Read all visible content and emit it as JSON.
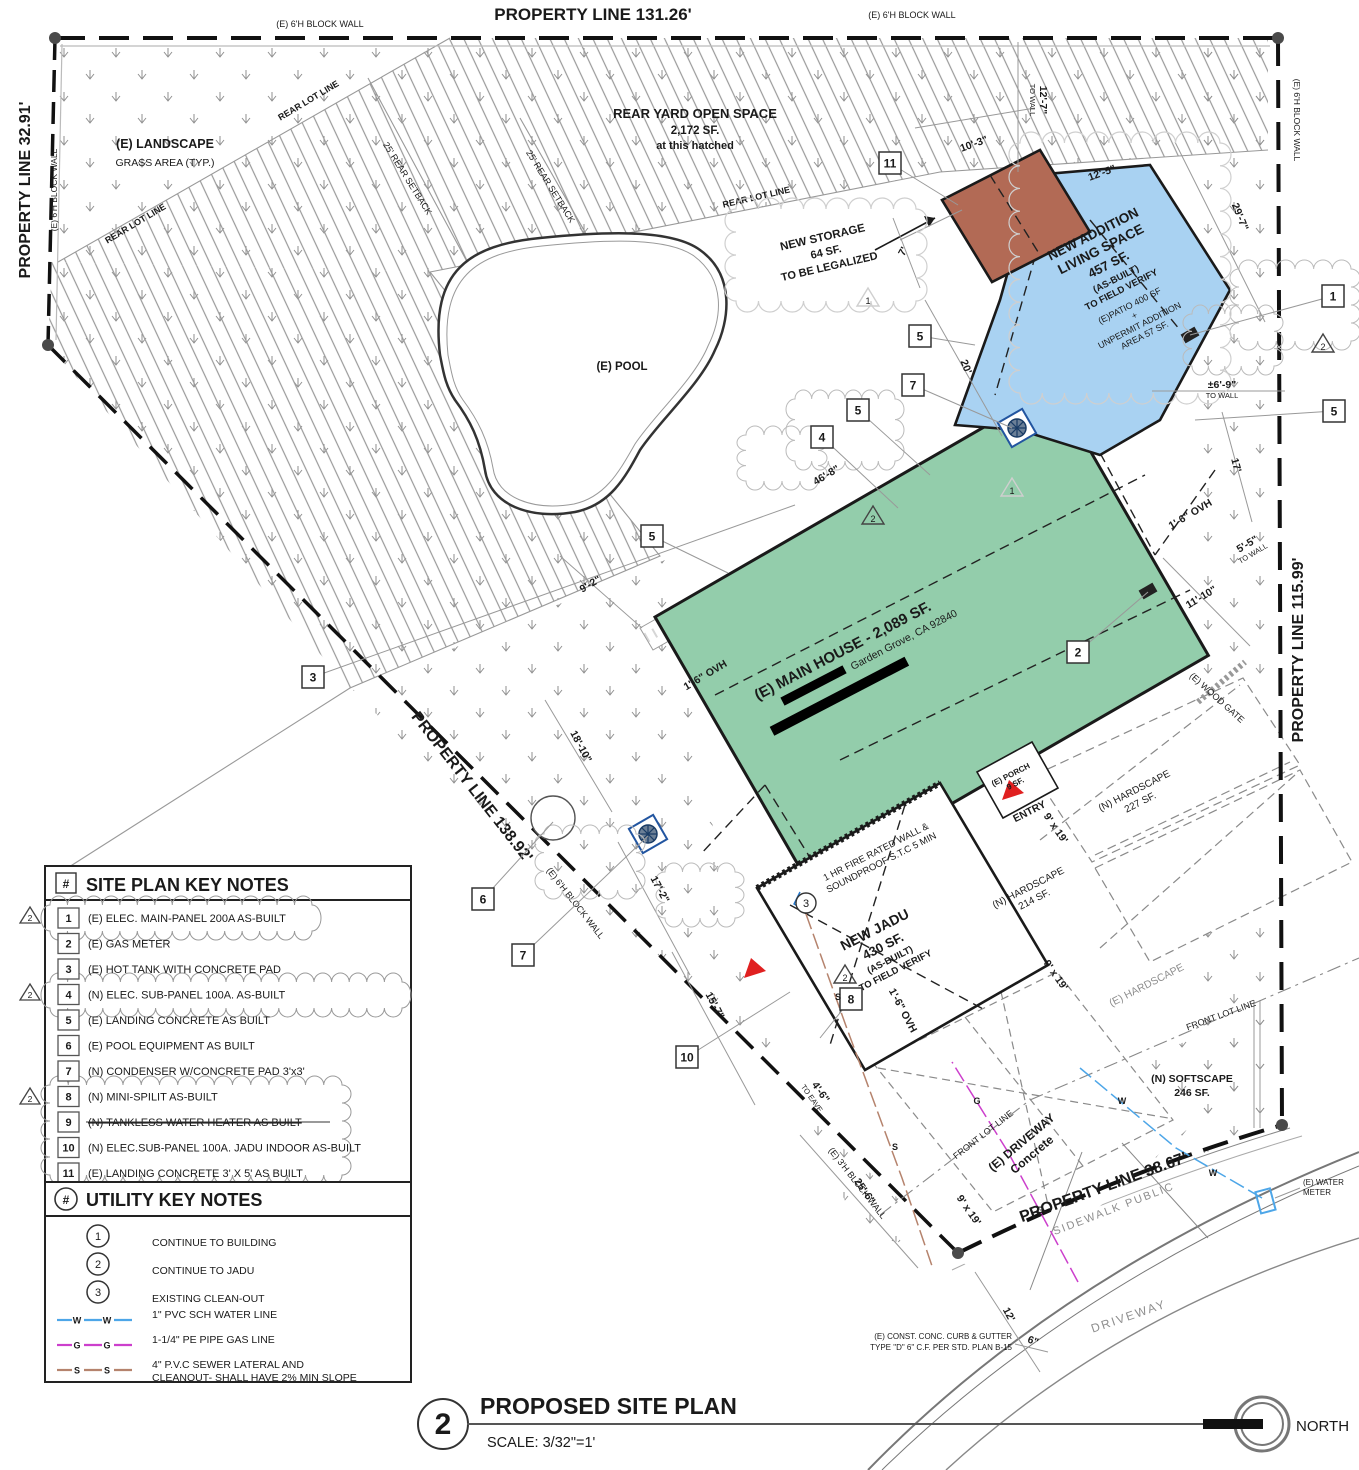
{
  "colors": {
    "house_green": "#93cdab",
    "addition_blue": "#a9d2f2",
    "storage_brown": "#b26a55",
    "hatch_gray": "#9a9a9a",
    "water_blue": "#4da6e8",
    "gas_magenta": "#cc3fcc",
    "sewer_brown": "#b5836d",
    "entry_red": "#e02020"
  },
  "boundary": {
    "top": "PROPERTY LINE 131.26'",
    "left": "PROPERTY LINE 32.91'",
    "right": "PROPERTY LINE 115.99'",
    "rear_diag": "PROPERTY LINE 138.92'",
    "front": "PROPERTY LINE 38.67'",
    "block_wall_6": "(E) 6'H BLOCK WALL",
    "block_wall_3": "(E) 3'H BLOCK WALL",
    "rear_lot_line": "REAR LOT LINE",
    "front_lot_line": "FRONT LOT LINE",
    "rear_setback": "25' REAR SETBACK",
    "sidewalk": "SIDEWALK   PUBLIC",
    "street": "DRIVEWAY",
    "wood_gate": "(E) WOOD GATE",
    "curb_note_1": "(E) CONST. CONC. CURB & GUTTER",
    "curb_note_2": "TYPE \"D\" 6\" C.F. PER STD. PLAN B-15"
  },
  "areas": {
    "landscape_1": "(E) LANDSCAPE",
    "landscape_2": "GRASS AREA (TYP.)",
    "rear_yard_1": "REAR YARD OPEN SPACE",
    "rear_yard_2": "2,172 SF.",
    "rear_yard_3": "at this hatched",
    "pool": "(E) POOL",
    "storage_1": "NEW STORAGE",
    "storage_2": "64 SF.",
    "storage_3": "TO BE LEGALIZED",
    "addition_1": "NEW ADDITION",
    "addition_2": "LIVING SPACE",
    "addition_3": "457 SF.",
    "addition_4": "(AS-BUILT)",
    "addition_5": "TO FIELD VERIFY",
    "addition_6": "(E)PATIO 400 SF",
    "addition_7": "+",
    "addition_8": "UNPERMIT ADDITION",
    "addition_9": "AREA 57 SF.",
    "main_house": "(E) MAIN HOUSE - 2,089 SF.",
    "main_house_addr": "Garden Grove, CA 92840",
    "jadu_1": "NEW JADU",
    "jadu_2": "430 SF.",
    "jadu_3": "(AS-BUILT)",
    "jadu_4": "TO FIELD VERIFY",
    "firewall_1": "1 HR FIRE RATED WALL &",
    "firewall_2": "SOUNDPROOF S.T.C 5 MIN",
    "porch_1": "(E) PORCH",
    "porch_2": "9 SF.",
    "entry": "ENTRY",
    "hardscape227_1": "(N) HARDSCAPE",
    "hardscape227_2": "227 SF.",
    "hardscape214_1": "(N) HARDSCAPE",
    "hardscape214_2": "214 SF.",
    "hardscape_e": "(E) HARDSCAPE",
    "softscape_1": "(N) SOFTSCAPE",
    "softscape_2": "246 SF.",
    "driveway_1": "(E) DRIVEWAY",
    "driveway_2": "Concrete",
    "water_meter_1": "(E) WATER",
    "water_meter_2": "METER"
  },
  "plan": {
    "dims": [
      {
        "t": "10'-3\"",
        "x": 975,
        "y": 147,
        "r": -20
      },
      {
        "t": "12'-5\"",
        "x": 1103,
        "y": 176,
        "r": -20
      },
      {
        "t": "12'-7\"",
        "sub": "TO WALL",
        "x": 1040,
        "y": 100,
        "r": 90
      },
      {
        "t": "29'-7\"",
        "x": 1237,
        "y": 218,
        "r": 68
      },
      {
        "t": "7'",
        "x": 906,
        "y": 253,
        "r": -62
      },
      {
        "t": "20'",
        "x": 963,
        "y": 368,
        "r": 68
      },
      {
        "t": "46'-8\"",
        "x": 828,
        "y": 478,
        "r": -31
      },
      {
        "t": "9'-2\"",
        "x": 592,
        "y": 587,
        "r": -31
      },
      {
        "t": "18'-10\"",
        "x": 578,
        "y": 748,
        "r": 62
      },
      {
        "t": "17'-2\"",
        "x": 657,
        "y": 891,
        "r": 62
      },
      {
        "t": "15'-7\"",
        "x": 712,
        "y": 1007,
        "r": 62
      },
      {
        "t": "4'-6\"",
        "sub": "TO EAVE",
        "x": 818,
        "y": 1094,
        "r": 55
      },
      {
        "t": "25'-6\"",
        "x": 862,
        "y": 1193,
        "r": 55
      },
      {
        "t": "12'",
        "x": 1006,
        "y": 1316,
        "r": 62
      },
      {
        "t": "6\"",
        "x": 1032,
        "y": 1344,
        "r": 20
      },
      {
        "t": "17'",
        "x": 1233,
        "y": 466,
        "r": 75
      },
      {
        "t": "1'-6\" OVH",
        "x": 1192,
        "y": 517,
        "r": -31
      },
      {
        "t": "5'-5\"",
        "sub": "TO WALL",
        "x": 1249,
        "y": 547,
        "r": -31
      },
      {
        "t": "11'-10\"",
        "x": 1203,
        "y": 600,
        "r": -31
      },
      {
        "t": "±6'-9\"",
        "sub": "TO WALL",
        "x": 1222,
        "y": 388,
        "r": 0
      },
      {
        "t": "1'-6\" OVH",
        "x": 707,
        "y": 678,
        "r": -31
      },
      {
        "t": "1'-6\" OVH",
        "x": 900,
        "y": 1012,
        "r": 62
      },
      {
        "t": "9' x 19'",
        "x": 1053,
        "y": 830,
        "r": 55
      },
      {
        "t": "9' x 19'",
        "x": 1053,
        "y": 977,
        "r": 55
      },
      {
        "t": "9' x 19'",
        "x": 966,
        "y": 1212,
        "r": 55
      }
    ],
    "keynote_markers": [
      {
        "n": "11",
        "x": 890,
        "y": 163,
        "tx": 958,
        "ty": 205
      },
      {
        "n": "5",
        "x": 920,
        "y": 336,
        "tx": 975,
        "ty": 345
      },
      {
        "n": "7",
        "x": 913,
        "y": 385,
        "tx": 1012,
        "ty": 428
      },
      {
        "n": "5",
        "x": 858,
        "y": 410,
        "tx": 930,
        "ty": 475
      },
      {
        "n": "4",
        "x": 822,
        "y": 437,
        "tx": 898,
        "ty": 508
      },
      {
        "n": "5",
        "x": 652,
        "y": 536,
        "tx": 728,
        "ty": 573
      },
      {
        "n": "3",
        "x": 313,
        "y": 677,
        "tx": 795,
        "ty": 505
      },
      {
        "n": "2",
        "x": 1078,
        "y": 652,
        "tx": 1148,
        "ty": 592
      },
      {
        "n": "1",
        "x": 1333,
        "y": 296,
        "tx": 1190,
        "ty": 335
      },
      {
        "n": "5",
        "x": 1334,
        "y": 411,
        "tx": 1195,
        "ty": 420
      },
      {
        "n": "6",
        "x": 483,
        "y": 899,
        "tx": 553,
        "ty": 822
      },
      {
        "n": "7",
        "x": 523,
        "y": 955,
        "tx": 648,
        "ty": 836
      },
      {
        "n": "10",
        "x": 687,
        "y": 1057,
        "tx": 790,
        "ty": 992
      },
      {
        "n": "8",
        "x": 851,
        "y": 999,
        "tx": 820,
        "ty": 1038
      }
    ],
    "rev_triangles": [
      {
        "n": "2",
        "x": 1323,
        "y": 344
      },
      {
        "n": "2",
        "x": 873,
        "y": 516
      },
      {
        "n": "2",
        "x": 845,
        "y": 975
      },
      {
        "n": "1",
        "x": 868,
        "y": 298,
        "faint": true
      },
      {
        "n": "1",
        "x": 1012,
        "y": 488,
        "faint": true
      }
    ],
    "utility_markers": [
      {
        "n": "3",
        "x": 806,
        "y": 903
      }
    ]
  },
  "site_key_notes": {
    "hash": "#",
    "title": "SITE PLAN KEY NOTES",
    "items": [
      {
        "n": "1",
        "text": "(E) ELEC. MAIN-PANEL 200A AS-BUILT",
        "cloud": true
      },
      {
        "n": "2",
        "text": "(E) GAS METER"
      },
      {
        "n": "3",
        "text": "(E) HOT TANK WITH CONCRETE PAD"
      },
      {
        "n": "4",
        "text": "(N) ELEC. SUB-PANEL 100A. AS-BUILT",
        "cloud": true
      },
      {
        "n": "5",
        "text": "(E) LANDING CONCRETE AS BUILT"
      },
      {
        "n": "6",
        "text": "(E) POOL EQUIPMENT AS BUILT"
      },
      {
        "n": "7",
        "text": "(N) CONDENSER W/CONCRETE PAD 3'x3'"
      },
      {
        "n": "8",
        "text": "(N) MINI-SPILIT AS-BUILT"
      },
      {
        "n": "9",
        "text": "(N) TANKLESS WATER HEATER AS BUILT",
        "struck": true
      },
      {
        "n": "10",
        "text": "(N) ELEC.SUB-PANEL 100A. JADU INDOOR AS-BUILT"
      },
      {
        "n": "11",
        "text": "(E) LANDING CONCRETE 3' X 5' AS BUILT"
      }
    ]
  },
  "utility_key_notes": {
    "hash": "#",
    "title": "UTILITY KEY NOTES",
    "notes": [
      {
        "n": "1",
        "text": "CONTINUE TO BUILDING"
      },
      {
        "n": "2",
        "text": "CONTINUE TO JADU"
      },
      {
        "n": "3",
        "text": "EXISTING CLEAN-OUT"
      }
    ],
    "lines": [
      {
        "letter": "W",
        "color": "#4da6e8",
        "label1": "1\" PVC SCH WATER LINE",
        "label2": ""
      },
      {
        "letter": "G",
        "color": "#cc3fcc",
        "label1": "1-1/4\" PE PIPE GAS LINE",
        "label2": ""
      },
      {
        "letter": "S",
        "color": "#b5836d",
        "label1": "4\" P.V.C SEWER LATERAL AND",
        "label2": "CLEANOUT- SHALL HAVE 2% MIN SLOPE"
      }
    ]
  },
  "titleblock": {
    "number": "2",
    "title": "PROPOSED SITE PLAN",
    "scale": "SCALE: 3/32\"=1'",
    "north": "NORTH"
  }
}
